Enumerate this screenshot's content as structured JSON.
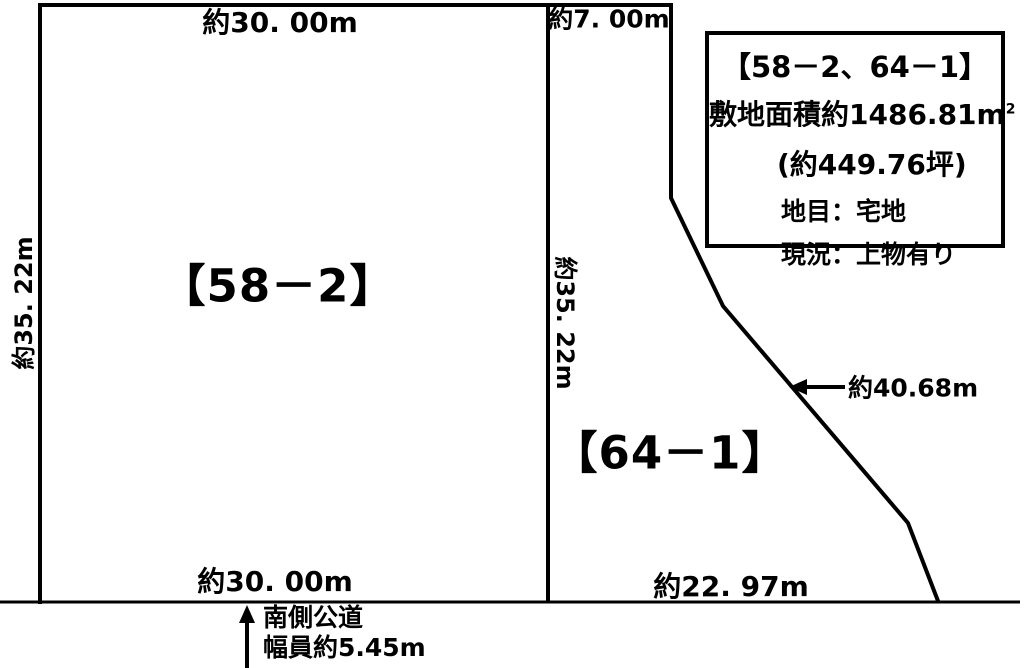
{
  "page": {
    "background": "#ffffff",
    "line_color": "#000000",
    "text_color": "#000000"
  },
  "parcels": {
    "left_label": "【58－2】",
    "right_label": "【64－1】"
  },
  "dimensions": {
    "top_width": "約30. 00m",
    "top_right_width": "約7. 00m",
    "left_height": "約35. 22m",
    "divider_height": "約35. 22m",
    "bottom_left_width": "約30. 00m",
    "bottom_right_width": "約22. 97m",
    "diagonal_length": "約40.68m"
  },
  "info_box": {
    "title": "【58－2、64－1】",
    "area_main": "敷地面積約1486.81m",
    "area_sup": "2",
    "area_tsubo": "(約449.76坪)",
    "land_category": "地目：宅地",
    "current_status": "現況：上物有り"
  },
  "road": {
    "name": "南側公道",
    "width": "幅員約5.45m"
  }
}
